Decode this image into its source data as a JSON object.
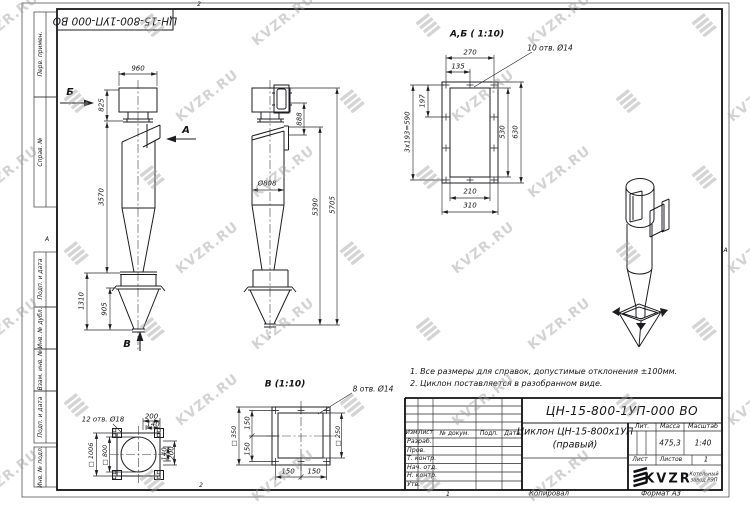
{
  "watermark": {
    "text": "KVZR.RU"
  },
  "frame": {
    "top_designation": "ЦН-15-800-1УП-000 ВО",
    "margin_labels": [
      "Перв. примен.",
      "Справ. №",
      "Подп. и дата",
      "Инв. № дубл.",
      "Взам. инв. №",
      "Подп. и дата",
      "Инв. № подл."
    ],
    "zone_top": "2",
    "zone_bottom": "2",
    "zone_left": "А",
    "zone_right": "А",
    "copy_number": "1",
    "copied_label": "Копировал",
    "format_label": "Формат А3"
  },
  "views": {
    "front": {
      "dir_b": "Б",
      "dir_a": "А",
      "dir_v": "В",
      "d960": "960",
      "d825": "825",
      "d3570": "3570",
      "d1310": "1310",
      "d905": "905"
    },
    "side": {
      "d888": "888",
      "d808": "Ø808",
      "d5390": "5390",
      "d5705": "5705"
    },
    "section_ab": {
      "title": "А,Б ( 1:10)",
      "holes": "10 отв. Ø14",
      "d270": "270",
      "d135": "135",
      "d197": "197",
      "d193": "3x193=590",
      "d530": "530",
      "d630": "630",
      "d210": "210",
      "d310": "310"
    },
    "bottom_flange": {
      "holes": "12 отв. Ø18",
      "d200_top": "200",
      "d140_top": "140",
      "d140_right": "140",
      "d200_right": "200",
      "d1006": "□ 1006",
      "d800": "□ 800"
    },
    "outlet_flange": {
      "title": "В (1:10)",
      "holes": "8 отв. Ø14",
      "d350": "□ 350",
      "d150_l1": "150",
      "d150_l2": "150",
      "d250": "□ 250",
      "d150_b1": "150",
      "d150_b2": "150"
    }
  },
  "notes": {
    "line1": "1. Все размеры для справок, допустимые отклонения ±100мм.",
    "line2": "2. Циклон поставляется в разобранном виде."
  },
  "title_block": {
    "designation": "ЦН-15-800-1УП-000 ВО",
    "name_line1": "Циклон ЦН-15-800х1УП",
    "name_line2": "(правый)",
    "col_izm": "Изм",
    "col_list": "Лист",
    "col_doc": "№ докум.",
    "col_podp": "Подп.",
    "col_data": "Дата",
    "rows": [
      "Разраб.",
      "Пров.",
      "Т. контр.",
      "Нач. отд.",
      "Н. контр.",
      "Утв."
    ],
    "lit_label": "Лит.",
    "mass_label": "Масса",
    "scale_label": "Масштаб",
    "mass_value": "475,3",
    "scale_value": "1:40",
    "sheet_label": "Лист",
    "sheets_label": "Листов",
    "sheets_value": "1",
    "logo_text": "KVZR",
    "logo_sub1": "Котельный",
    "logo_sub2": "завод РЭП"
  }
}
